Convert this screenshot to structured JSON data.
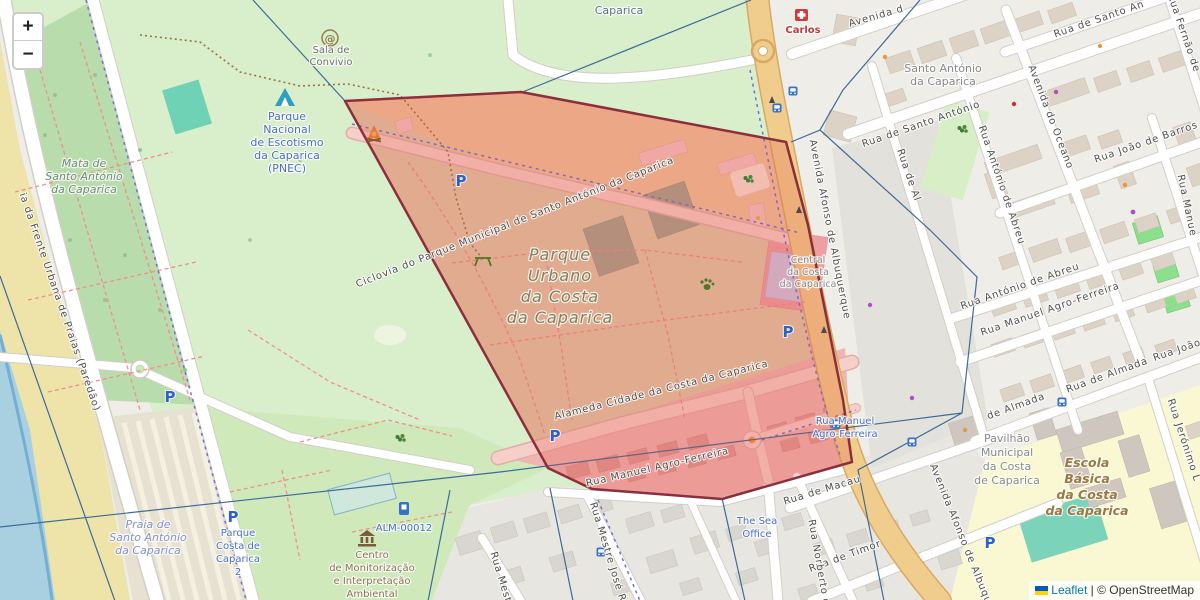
{
  "ui": {
    "zoom_in": "+",
    "zoom_out": "−",
    "attribution": {
      "flag": "ukraine-flag",
      "leaflet": "Leaflet",
      "separator": "|",
      "osm_copyright": "© OpenStreetMap"
    }
  },
  "icons": {
    "parking_glyph": "P",
    "at_glyph": "@"
  },
  "colors": {
    "overlay_polygon_fill": "#e54a42",
    "overlay_polygon_border": "#8c2f3c",
    "park_green": "#d9eecb",
    "forest_green": "#b8dcab",
    "water_blue": "#a8d0e0",
    "sand": "#eee3a9",
    "avenue_tan": "#f1cd8d",
    "school_yellow": "#f9f8d3",
    "pitch_teal": "#79d3b8",
    "poi_blue": "#4a70c8",
    "leaflet_link": "#0078a8"
  },
  "labels": {
    "caparica": {
      "text": "Caparica"
    },
    "mata": {
      "lines": [
        "Mata de",
        "Santo António",
        "da Caparica"
      ]
    },
    "pnec": {
      "lines": [
        "Parque",
        "Nacional",
        "de Escotismo",
        "da Caparica",
        "(PNEC)"
      ]
    },
    "sala_convivio": {
      "lines": [
        "Sala de",
        "Convivio"
      ]
    },
    "carlos": {
      "text": "Carlos"
    },
    "santo_antonio": {
      "lines": [
        "Santo António",
        "da Caparica"
      ]
    },
    "parque_urbano": {
      "lines": [
        "Parque",
        "Urbano",
        "da Costa",
        "da Caparica"
      ]
    },
    "central": {
      "lines": [
        "Central",
        "da Costa",
        "da Caparica"
      ]
    },
    "praia": {
      "lines": [
        "Praia de",
        "Santo António",
        "da Caparica"
      ]
    },
    "parque_costa": {
      "lines": [
        "Parque",
        "Costa de",
        "Caparica",
        "2"
      ]
    },
    "centro_monitorizacao": {
      "lines": [
        "Centro",
        "de Monitorização",
        "e Interpretação",
        "Ambiental"
      ]
    },
    "alm": {
      "text": "ALM-00012"
    },
    "sea_office": {
      "lines": [
        "The Sea",
        "Office"
      ]
    },
    "escola": {
      "lines": [
        "Escola",
        "Básica",
        "da Costa",
        "da Caparica"
      ]
    },
    "pavilhao": {
      "lines": [
        "Pavilhão",
        "Municipal",
        "da Costa",
        "de Caparica"
      ]
    },
    "rua_manuel_cycle": {
      "lines": [
        "Rua Manuel",
        "Agro-Ferreira"
      ]
    }
  },
  "streets": {
    "ciclovia_parque": {
      "text": "Ciclovia do Parque Municipal de Santo António da Caparica"
    },
    "alameda": {
      "text": "Alameda Cidade da Costa da Caparica"
    },
    "rua_manuel_sul": {
      "text": "Rua Manuel Agro-Ferreira"
    },
    "av_afonso_a": {
      "text": "Avenida Afonso de Albuquerque"
    },
    "av_afonso_b": {
      "text": "Avenida Afonso de Albuqu"
    },
    "rua_sto_antonio": {
      "text": "Rua de Santo António"
    },
    "rua_sto_antonio_b": {
      "text": "Rua de Santo An"
    },
    "avenida_d": {
      "text": "Avenida d"
    },
    "av_oceano": {
      "text": "Avenida do Oceano"
    },
    "rua_joao": {
      "text": "Rua João de Barros"
    },
    "rua_joao_b": {
      "text": "Rua João"
    },
    "rua_antonio_v": {
      "text": "Rua António de Abreu"
    },
    "rua_antonio_h": {
      "text": "Rua António de Abreu"
    },
    "rua_manuel_e": {
      "text": "Rua Manuel Agro-Ferreira"
    },
    "rua_almada_1": {
      "text": "Rua de Almada"
    },
    "rua_almada_2": {
      "text": "de Almada"
    },
    "rua_almada_v": {
      "text": "Rua de Al"
    },
    "rua_fernao": {
      "text": "Rua Fernão de"
    },
    "rua_manuel_v": {
      "text": "Rua Manue"
    },
    "rua_jeronimo": {
      "text": "Rua Jerónimo L"
    },
    "rua_macau": {
      "text": "Rua de Macau"
    },
    "rua_timor": {
      "text": "Rua de Timor"
    },
    "rua_norberto": {
      "text": "Rua Norberto d"
    },
    "rua_mestre": {
      "text": "Rua Mestre José Ra"
    },
    "rua_mest": {
      "text": "Rua Mest"
    },
    "ciclovia_frente": {
      "text": "ia da Frente Urbana de Praias (Paredão)"
    }
  }
}
